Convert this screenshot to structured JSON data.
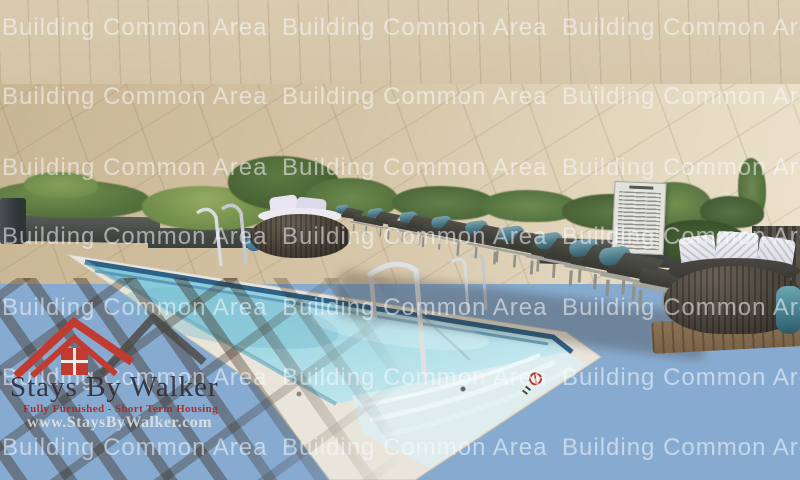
{
  "watermark": {
    "text": "Building Common Area",
    "color": "#ffffff",
    "opacity": 0.55,
    "rows": 7,
    "columns": 3
  },
  "logo": {
    "title": "Stays By Walker",
    "tagline": "Fully Furnished - Short Term Housing",
    "website": "www.StaysByWalker.com",
    "roof_color_red": "#c23b31",
    "roof_color_dark": "#4c4a46"
  },
  "signs": {
    "lifeguard_line1": "LIFEGUARD",
    "lifeguard_line2": "ON DUTY"
  },
  "palette": {
    "sky_top": "#3f6ba2",
    "sky_horizon": "#c2d6e8",
    "water": "#8ecfdd",
    "water_shallow": "#d5edf1",
    "waterline_tile": "#2c6188",
    "coping": "#e9e5da",
    "deck": "#d6c6a8",
    "cushion_teal": "#477381",
    "lounger_seat": "#44443e",
    "fence": "#1c2b39",
    "foliage": "#5d7a42",
    "wicker": "#4a443c",
    "pillow": "#eaeaee"
  }
}
